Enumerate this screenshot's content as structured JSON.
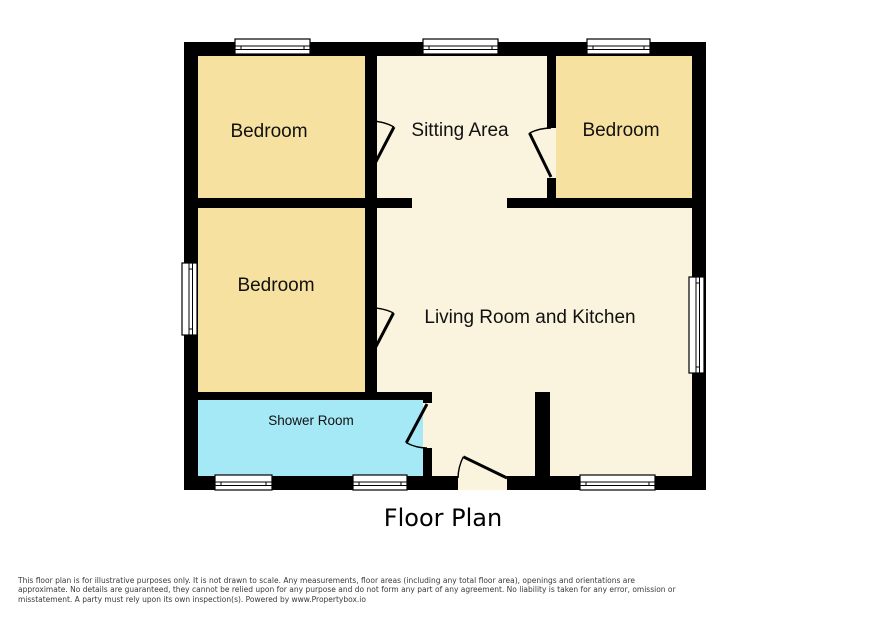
{
  "floor_plan": {
    "title": "Floor Plan",
    "rooms": [
      {
        "id": "bedroom-top-left",
        "label": "Bedroom"
      },
      {
        "id": "sitting-area",
        "label": "Sitting Area"
      },
      {
        "id": "bedroom-top-right",
        "label": "Bedroom"
      },
      {
        "id": "bedroom-mid-left",
        "label": "Bedroom"
      },
      {
        "id": "living-room-kitchen",
        "label": "Living Room and Kitchen"
      },
      {
        "id": "shower-room",
        "label": "Shower Room"
      }
    ],
    "colors": {
      "wall": "#000000",
      "bedroom_fill": "#F6E1A0",
      "living_fill": "#FAF4DE",
      "shower_fill": "#A5E9F7",
      "window_fill": "#FFFFFF"
    }
  },
  "disclaimer": {
    "lines": [
      "This floor plan is for illustrative purposes only. It is not drawn to scale. Any measurements, floor areas (including any total floor area), openings and orientations are",
      "approximate. No details are guaranteed, they cannot be relied upon for any purpose and do not form any part of any agreement. No liability is taken for any error, omission or",
      "misstatement. A party must rely upon its own inspection(s). Powered by www.Propertybox.io"
    ]
  }
}
